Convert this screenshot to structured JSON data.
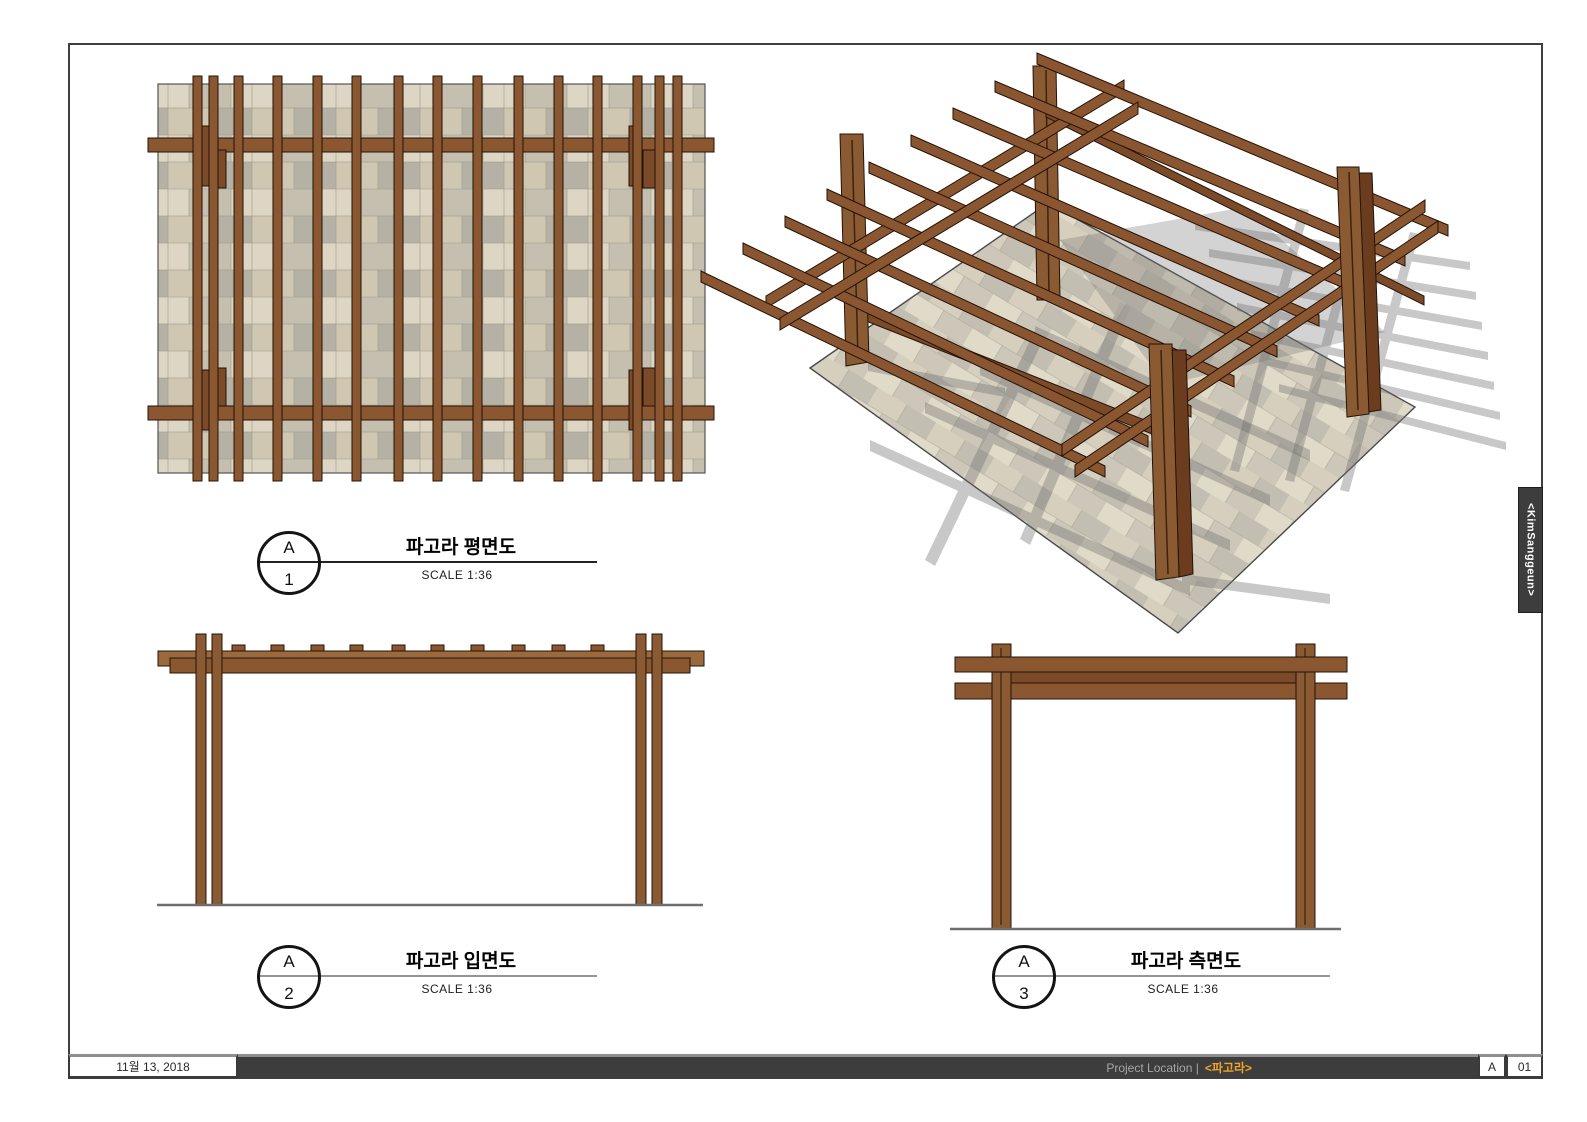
{
  "sheet": {
    "views": [
      {
        "id": "plan",
        "circle_top": "A",
        "circle_bottom": "1",
        "title": "파고라 평면도",
        "scale": "SCALE 1:36"
      },
      {
        "id": "elevation",
        "circle_top": "A",
        "circle_bottom": "2",
        "title": "파고라 입면도",
        "scale": "SCALE 1:36"
      },
      {
        "id": "side",
        "circle_top": "A",
        "circle_bottom": "3",
        "title": "파고라 측면도",
        "scale": "SCALE 1:36"
      }
    ],
    "footer": {
      "date": "11월 13, 2018",
      "project_location_label": "Project Location |",
      "project_name": "<파고라>",
      "sheet_letter": "A",
      "sheet_number": "01"
    },
    "side_tab": {
      "label": "<KimSanggeun>"
    },
    "colors": {
      "wood": "#8a5731",
      "wood_light": "#9a6a3c",
      "wood_dark": "#7b4a28",
      "outline": "#241307",
      "accent_orange": "#f0a32a",
      "footer_bar": "#3d3d3d",
      "paver_beige": "#d3cbb6",
      "paver_gray": "#b5b1a4",
      "paver_light": "#ddd6c4",
      "shadow_gray": "#707070"
    }
  }
}
